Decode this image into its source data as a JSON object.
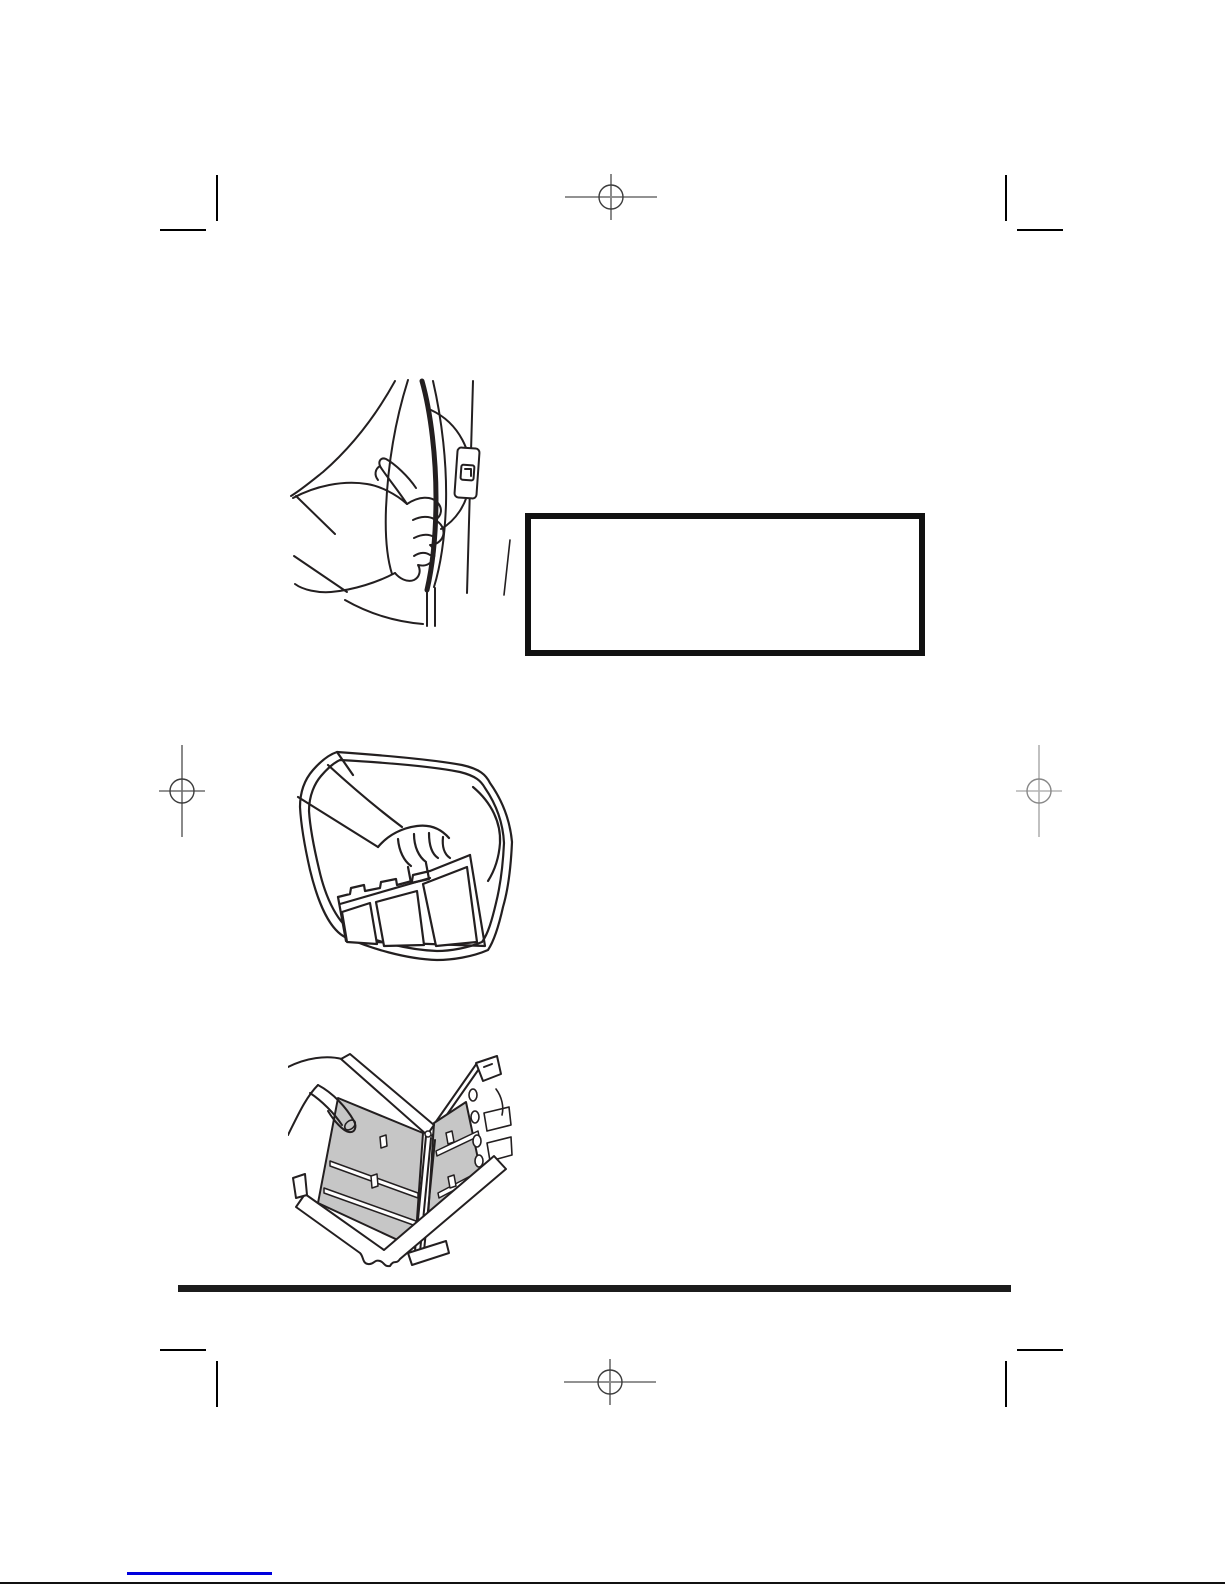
{
  "page": {
    "kind": "appliance-manual-page-proof",
    "background": "#ffffff"
  },
  "colors": {
    "line_art": "#231f20",
    "crop_mark": "#000000",
    "registration_mark": "#6e6e6e",
    "registration_mark_light": "#a0a0a0",
    "callout_border": "#111111",
    "section_rule": "#1c1c1c",
    "footer_link": "#0000dd",
    "page_edge_line": "#111111",
    "screen_fill": "#c6c6c6"
  },
  "callout_box": {
    "content": ""
  },
  "figures": [
    {
      "name": "hand-opening-dryer-door-illustration"
    },
    {
      "name": "hand-removing-lint-filter-illustration"
    },
    {
      "name": "opened-lint-filter-screens-illustration"
    }
  ],
  "marks": {
    "registration": [
      "top-center",
      "left-middle",
      "right-middle",
      "bottom-center"
    ],
    "crop_corners": [
      "top-left",
      "top-right",
      "bottom-left",
      "bottom-right"
    ]
  }
}
